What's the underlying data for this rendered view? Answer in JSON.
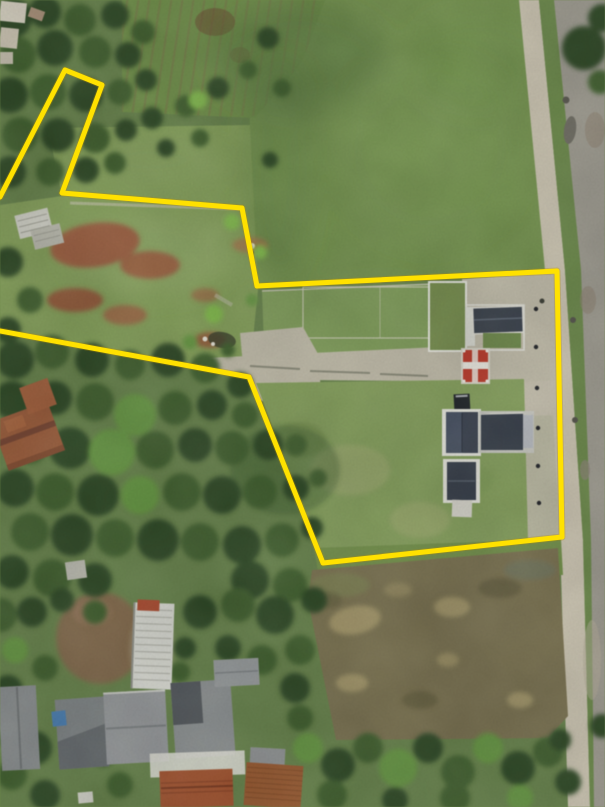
{
  "meta": {
    "type": "aerial-drone-photograph",
    "description": "Top-down aerial photo of a land plot survey: a yellow boundary polyline outlines an irregular parcel with a narrow flag strip at the upper left, bounded by a paved road on the right, a large green field to the north, dense tree canopy and village rooftops to the south-west, and a muddy brown field below the parcel."
  },
  "annotation": {
    "boundary_color": "#FFE100",
    "boundary_width": 5,
    "boundary_points": "0,197 65,70 102,85 62,193 242,208 257,286 557,271 562,537 323,563 249,377 0,331",
    "vertex_count": 11
  },
  "palette": {
    "field_green": "#75954e",
    "clearing_green": "#83a058",
    "parcel_grass_south": "#84a05b",
    "plot_grass": "#7f9e59",
    "canopy_dark": "#2e4a26",
    "canopy_bright": "#639540",
    "road_concrete": "#cbc4b1",
    "road_median": "#6b8a49",
    "road_asphalt": "#9e9b90",
    "paving": "#bfbaa8",
    "earth_red": "#a2543c",
    "mud_brown": "#7b7250",
    "roof_dark": "#3c4350",
    "roof_metal_gray": "#8b8f91",
    "roof_red_tile": "#9c5b3a",
    "gatehouse_red": "#c23b2b",
    "wall_white": "#e3e3db"
  },
  "features": [
    {
      "name": "surveyed-parcel",
      "outline": "yellow"
    },
    {
      "name": "flag-strip-extension",
      "outline": "yellow"
    },
    {
      "name": "large-green-field"
    },
    {
      "name": "grass-clearing-with-red-soil-patches"
    },
    {
      "name": "paved-road-with-grass-median"
    },
    {
      "name": "internal-paved-paths"
    },
    {
      "name": "dark-roof-houses",
      "count": 4
    },
    {
      "name": "red-roof-gatehouse"
    },
    {
      "name": "white-walled-enclosure"
    },
    {
      "name": "dense-tree-canopy"
    },
    {
      "name": "village-rooftops"
    },
    {
      "name": "long-white-ribbed-roof-building"
    },
    {
      "name": "red-tile-roof-houses"
    },
    {
      "name": "muddy-brown-field"
    },
    {
      "name": "crop-row-farmland"
    },
    {
      "name": "farm-shed"
    }
  ]
}
